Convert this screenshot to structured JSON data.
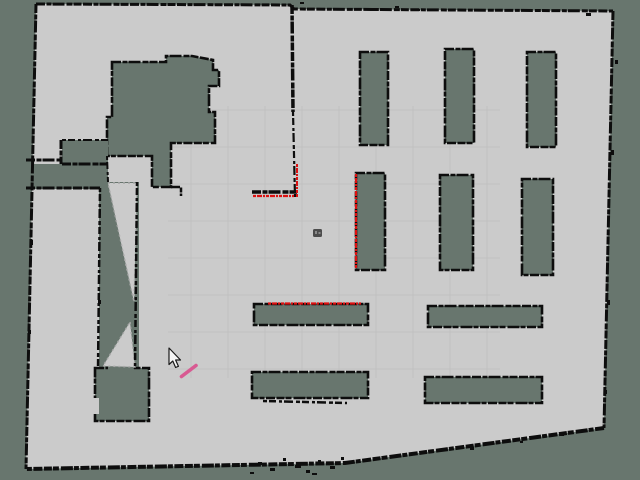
{
  "app": {
    "view_label": "occupancy-grid-map-view"
  },
  "colors": {
    "unknown": "#68766e",
    "free": "#cbcbcb",
    "wall": "#0d0d0d",
    "grid": "#c0c0c0",
    "laser": "#dd1111",
    "robot_body": "#4c4c4c",
    "robot_highlight": "#8a8a8a",
    "annotation_pink": "#d85a92",
    "cursor_fill": "#f5f5f5",
    "cursor_outline": "#1a1a1a",
    "ray_edge": "#a8a8a8"
  },
  "map": {
    "outline_points": [
      [
        36,
        4
      ],
      [
        290,
        5
      ],
      [
        294,
        9
      ],
      [
        613,
        11
      ],
      [
        604,
        428
      ],
      [
        345,
        463
      ],
      [
        26,
        469
      ]
    ],
    "grid": {
      "region": [
        168,
        106,
        500,
        378
      ],
      "vertical_x": [
        191,
        228,
        265,
        302,
        339,
        376,
        413,
        450,
        487
      ],
      "horizontal_y": [
        110,
        147,
        184,
        221,
        258,
        295,
        332,
        369
      ]
    },
    "unknown_regions": [
      {
        "name": "top-left-room",
        "type": "polygon",
        "stroke": true,
        "points": [
          [
            112,
            62
          ],
          [
            166,
            62
          ],
          [
            166,
            56
          ],
          [
            192,
            56
          ],
          [
            213,
            60
          ],
          [
            213,
            70
          ],
          [
            219,
            70
          ],
          [
            219,
            86
          ],
          [
            209,
            86
          ],
          [
            209,
            112
          ],
          [
            215,
            112
          ],
          [
            215,
            143
          ],
          [
            171,
            143
          ],
          [
            171,
            187
          ],
          [
            152,
            187
          ],
          [
            152,
            156
          ],
          [
            107,
            156
          ],
          [
            107,
            117
          ],
          [
            112,
            117
          ]
        ]
      },
      {
        "name": "left-pocket-block",
        "type": "rect",
        "rect": [
          62,
          140,
          46,
          26
        ]
      },
      {
        "name": "left-strip",
        "type": "rect",
        "rect": [
          26,
          164,
          82,
          25
        ]
      },
      {
        "name": "corridor",
        "type": "rect",
        "rect": [
          99,
          182,
          40,
          189
        ]
      },
      {
        "name": "bottom-room",
        "type": "rect",
        "stroke": true,
        "rect": [
          95,
          368,
          54,
          53
        ]
      }
    ],
    "corridor_rays": [
      {
        "name": "ray-wedge-upper",
        "points": [
          [
            108,
            183
          ],
          [
            137,
            183
          ],
          [
            134,
            302
          ]
        ]
      },
      {
        "name": "ray-wedge-lower",
        "points": [
          [
            130,
            322
          ],
          [
            135,
            367
          ],
          [
            103,
            366
          ]
        ]
      }
    ],
    "pillars": [
      {
        "name": "pillar-top-1",
        "rect": [
          360,
          52,
          28,
          93
        ]
      },
      {
        "name": "pillar-top-2",
        "rect": [
          445,
          49,
          29,
          94
        ]
      },
      {
        "name": "pillar-top-3",
        "rect": [
          527,
          52,
          29,
          95
        ]
      },
      {
        "name": "pillar-mid-1",
        "rect": [
          356,
          173,
          29,
          97
        ]
      },
      {
        "name": "pillar-mid-2",
        "rect": [
          440,
          175,
          33,
          95
        ]
      },
      {
        "name": "pillar-mid-3",
        "rect": [
          522,
          179,
          31,
          96
        ]
      },
      {
        "name": "shelf-bar-1",
        "rect": [
          254,
          304,
          114,
          21
        ]
      },
      {
        "name": "shelf-bar-2",
        "rect": [
          428,
          306,
          114,
          21
        ]
      },
      {
        "name": "shelf-bar-3",
        "rect": [
          252,
          372,
          116,
          26
        ]
      },
      {
        "name": "shelf-bar-4",
        "rect": [
          425,
          377,
          117,
          26
        ]
      }
    ],
    "walls": [
      {
        "name": "boundary-top",
        "pts": [
          [
            36,
            4
          ],
          [
            290,
            5
          ],
          [
            294,
            9
          ],
          [
            613,
            11
          ]
        ],
        "w": 3
      },
      {
        "name": "boundary-right",
        "pts": [
          [
            613,
            11
          ],
          [
            604,
            428
          ]
        ],
        "w": 3
      },
      {
        "name": "boundary-bottom",
        "pts": [
          [
            604,
            428
          ],
          [
            345,
            463
          ],
          [
            26,
            469
          ]
        ],
        "w": 4
      },
      {
        "name": "boundary-left",
        "pts": [
          [
            36,
            4
          ],
          [
            26,
            469
          ]
        ],
        "w": 3
      },
      {
        "name": "pocket-top-edge",
        "pts": [
          [
            62,
            140
          ],
          [
            108,
            140
          ]
        ],
        "w": 2,
        "sparse": true
      },
      {
        "name": "pocket-divider",
        "pts": [
          [
            61,
            140
          ],
          [
            61,
            164
          ]
        ],
        "w": 3
      },
      {
        "name": "strip-top-left",
        "pts": [
          [
            26,
            160
          ],
          [
            62,
            160
          ]
        ],
        "w": 3
      },
      {
        "name": "strip-top-right",
        "pts": [
          [
            62,
            164
          ],
          [
            108,
            164
          ]
        ],
        "w": 3
      },
      {
        "name": "strip-bottom",
        "pts": [
          [
            26,
            188
          ],
          [
            100,
            188
          ]
        ],
        "w": 3
      },
      {
        "name": "corridor-left-wall",
        "pts": [
          [
            100,
            188
          ],
          [
            98,
            369
          ]
        ],
        "w": 2.5,
        "sparse": true
      },
      {
        "name": "corridor-right-wall",
        "pts": [
          [
            137,
            182
          ],
          [
            135,
            369
          ]
        ],
        "w": 2.5,
        "sparse": true
      },
      {
        "name": "corridor-mouth",
        "pts": [
          [
            107,
            156
          ],
          [
            108,
            182
          ]
        ],
        "w": 2,
        "sparse": true
      },
      {
        "name": "column-corner",
        "pts": [
          [
            171,
            187
          ],
          [
            181,
            187
          ],
          [
            181,
            196
          ]
        ],
        "w": 2.5
      },
      {
        "name": "center-wall-stub-upper",
        "pts": [
          [
            292,
            5
          ],
          [
            293,
            112
          ]
        ],
        "w": 3.5
      },
      {
        "name": "center-wall-stub-lower",
        "pts": [
          [
            293,
            112
          ],
          [
            295,
            197
          ]
        ],
        "w": 2.2,
        "sparse": true
      },
      {
        "name": "center-L-wall",
        "pts": [
          [
            252,
            192
          ],
          [
            297,
            192
          ]
        ],
        "w": 3.5
      },
      {
        "name": "below-shelf3-line",
        "pts": [
          [
            263,
            401
          ],
          [
            347,
            403
          ]
        ],
        "w": 2.5,
        "sparse": true
      }
    ],
    "laser_segments": [
      {
        "name": "scan-center-vertical",
        "pts": [
          [
            297,
            164
          ],
          [
            297,
            197
          ]
        ],
        "w": 2
      },
      {
        "name": "scan-center-horizontal",
        "pts": [
          [
            253,
            196
          ],
          [
            294,
            196
          ]
        ],
        "w": 2.2
      },
      {
        "name": "scan-pillar-mid-1",
        "pts": [
          [
            356,
            174
          ],
          [
            356,
            269
          ]
        ],
        "w": 2.2
      },
      {
        "name": "scan-shelf-bar-1",
        "pts": [
          [
            268,
            303.5
          ],
          [
            361,
            303.5
          ]
        ],
        "w": 2.2
      }
    ],
    "noise_dots": [
      [
        258,
        462,
        4,
        3
      ],
      [
        270,
        468,
        5,
        3
      ],
      [
        283,
        458,
        3,
        3
      ],
      [
        295,
        465,
        6,
        3
      ],
      [
        306,
        470,
        4,
        3
      ],
      [
        318,
        460,
        3,
        2
      ],
      [
        330,
        466,
        5,
        3
      ],
      [
        341,
        457,
        3,
        3
      ],
      [
        250,
        472,
        4,
        2
      ],
      [
        312,
        473,
        5,
        2
      ],
      [
        470,
        447,
        4,
        3
      ],
      [
        520,
        441,
        3,
        2
      ],
      [
        560,
        434,
        4,
        2
      ],
      [
        370,
        8,
        5,
        3
      ],
      [
        395,
        6,
        4,
        2
      ],
      [
        415,
        9,
        5,
        2
      ],
      [
        300,
        2,
        4,
        2
      ],
      [
        586,
        13,
        5,
        3
      ],
      [
        615,
        60,
        3,
        4
      ],
      [
        611,
        150,
        3,
        5
      ],
      [
        607,
        300,
        3,
        5
      ],
      [
        604,
        390,
        3,
        4
      ],
      [
        30,
        240,
        3,
        5
      ],
      [
        28,
        330,
        3,
        4
      ],
      [
        98,
        300,
        3,
        4
      ]
    ],
    "bottom_room_notch": [
      92,
      398,
      7,
      16
    ],
    "bottom_room_opening": [
      108,
      364,
      26,
      9
    ],
    "robot": {
      "x": 313,
      "y": 229,
      "w": 9,
      "h": 8
    },
    "cursor": {
      "tip_x": 169,
      "tip_y": 348
    },
    "annotation_stroke": {
      "x1": 181.5,
      "y1": 376.5,
      "x2": 196,
      "y2": 365.5,
      "w": 3.6
    }
  }
}
